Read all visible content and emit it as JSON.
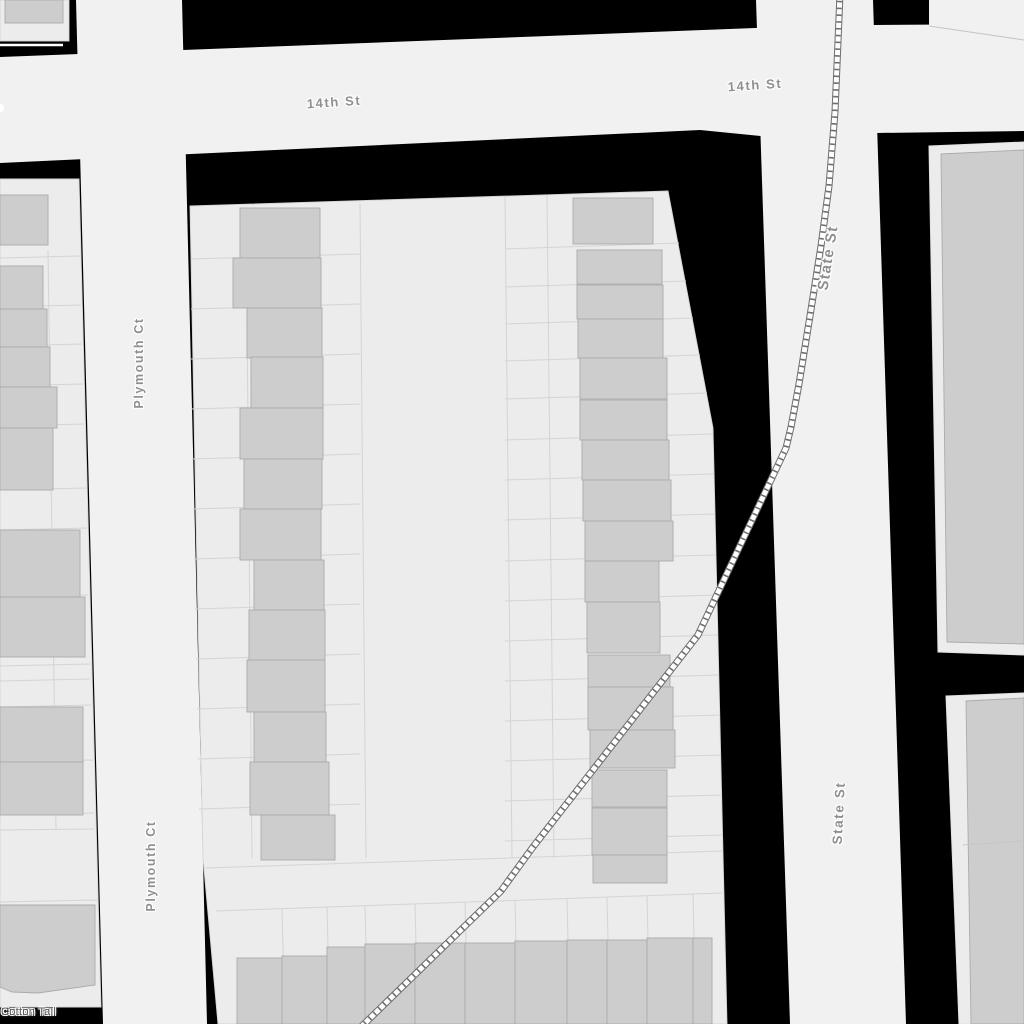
{
  "map": {
    "kind": "street-map-detail",
    "street_labels": {
      "fourteenth_west": "14th St",
      "fourteenth_east": "14th St",
      "plymouth_north": "Plymouth Ct",
      "plymouth_south": "Plymouth Ct",
      "state_north": "State St",
      "state_south": "State St",
      "cotton_tail": "Cotton Tail"
    },
    "street_names": [
      "14th St",
      "Plymouth Ct",
      "State St",
      "Cotton Tail"
    ],
    "features": [
      "railway-track",
      "buildings",
      "parcels",
      "roads"
    ]
  },
  "colors": {
    "background": "#000000",
    "road_fill": "#f1f1f1",
    "block_fill": "#ececec",
    "building_fill": "#cdcdcd",
    "building_stroke": "#ababab",
    "parcel_line": "#d4d4d4",
    "rail_dark": "#6e6e6e",
    "rail_light": "#ffffff",
    "label_color": "#8f8f8f",
    "trail_label_color": "#5a5a5a"
  }
}
